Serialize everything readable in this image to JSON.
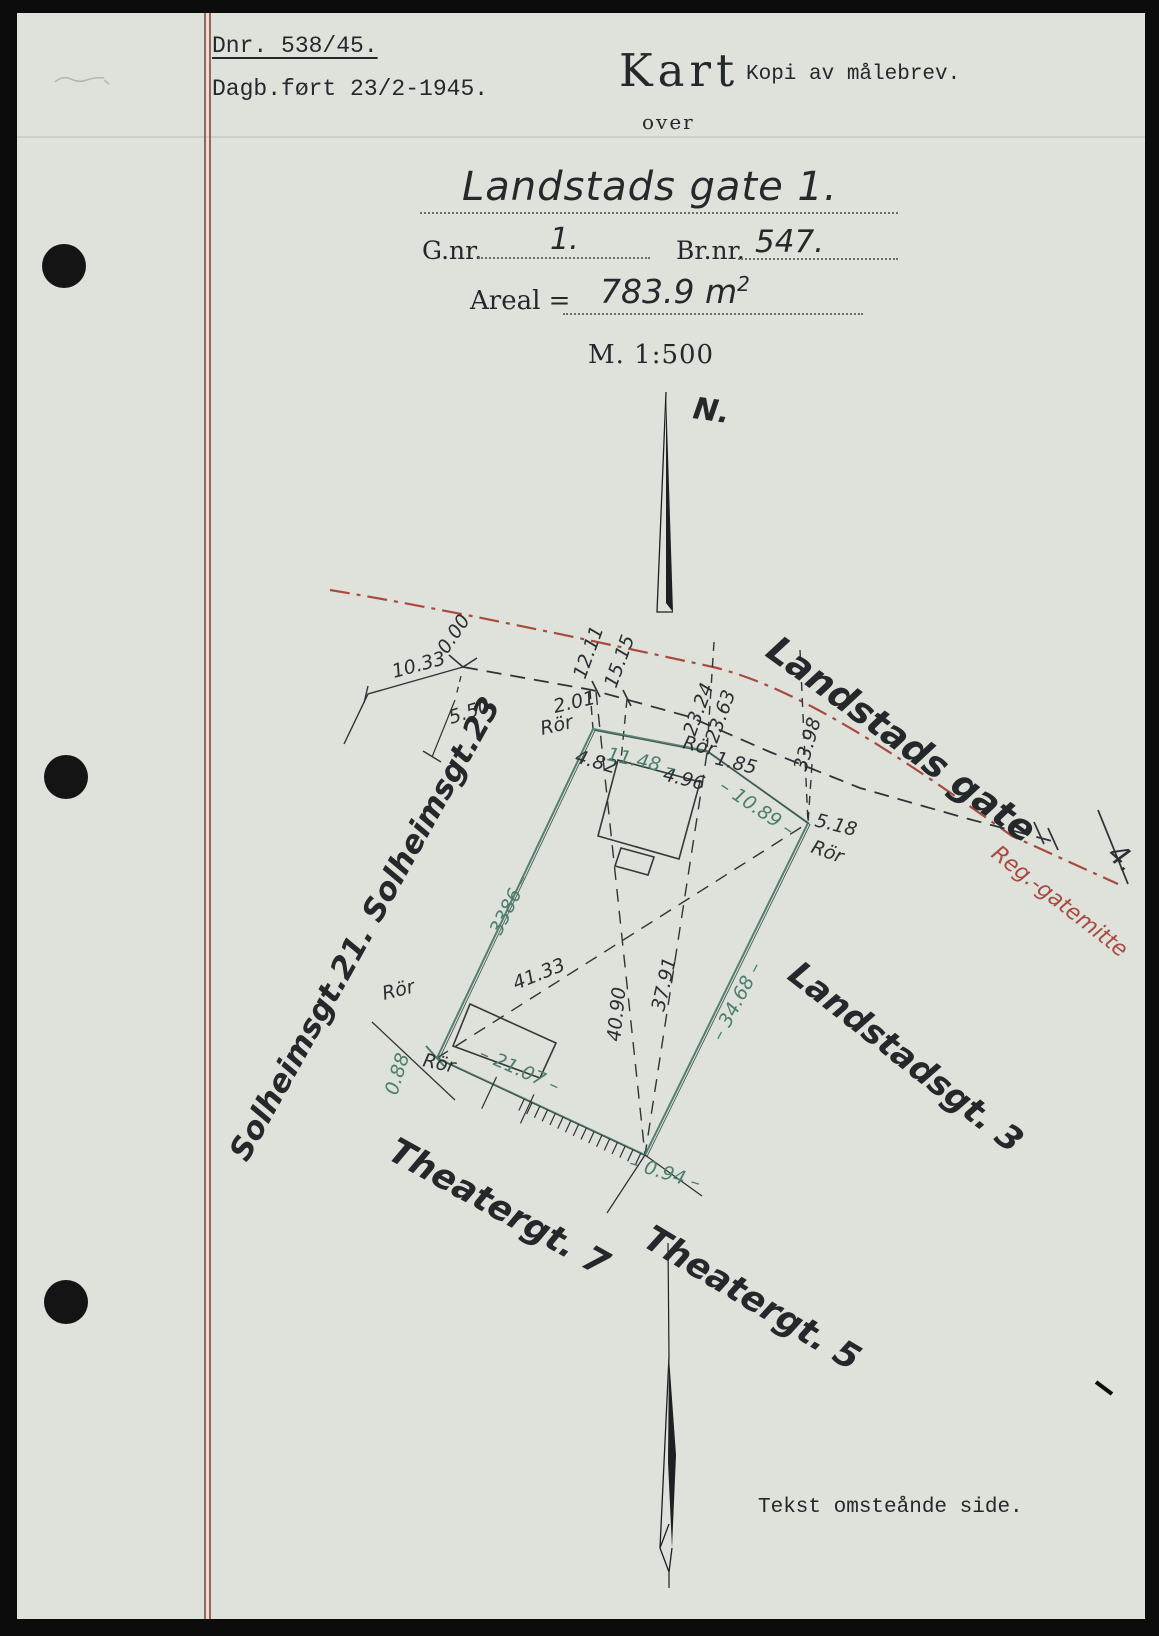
{
  "header": {
    "dnr": "Dnr. 538/45.",
    "dagb": "Dagb.ført 23/2-1945.",
    "kart": "Kart",
    "kopi": "Kopi av målebrev.",
    "over": "over"
  },
  "title": {
    "street": "Landstads gate 1.",
    "gnr_label": "G.nr.",
    "gnr_value": "1.",
    "brnr_label": "Br.nr.",
    "brnr_value": "547.",
    "areal_label": "Areal =",
    "areal_value": "783.9 m",
    "areal_sup": "2",
    "scale": "M. 1:500"
  },
  "footer": {
    "note": "Tekst omsteånde side."
  },
  "colors": {
    "paper": "#dee2db",
    "ink": "#2b2f31",
    "green": "#4c7e6c",
    "red": "#a84a3f"
  },
  "map": {
    "labels": [
      {
        "t": "10.33",
        "x": 394,
        "y": 678,
        "r": -15
      },
      {
        "t": "0.00",
        "x": 447,
        "y": 655,
        "r": -56
      },
      {
        "t": "5.50",
        "x": 451,
        "y": 724,
        "r": -17
      },
      {
        "t": "12.11",
        "x": 585,
        "y": 680,
        "r": -70
      },
      {
        "t": "15.15",
        "x": 616,
        "y": 689,
        "r": -70
      },
      {
        "t": "2.01",
        "x": 555,
        "y": 713,
        "r": -13
      },
      {
        "t": "Rör",
        "x": 542,
        "y": 735,
        "r": -13
      },
      {
        "t": "23.24",
        "x": 695,
        "y": 737,
        "r": -70
      },
      {
        "t": "23.63",
        "x": 717,
        "y": 744,
        "r": -70
      },
      {
        "t": "Rör",
        "x": 682,
        "y": 748,
        "r": 14
      },
      {
        "t": "1.85",
        "x": 714,
        "y": 764,
        "r": 14
      },
      {
        "t": "4.82",
        "x": 574,
        "y": 762,
        "r": 16
      },
      {
        "t": "4.96",
        "x": 662,
        "y": 780,
        "r": 14
      },
      {
        "t": "33.98",
        "x": 806,
        "y": 772,
        "r": -74
      },
      {
        "t": "5.18",
        "x": 814,
        "y": 826,
        "r": 14
      },
      {
        "t": "Rör",
        "x": 810,
        "y": 852,
        "r": 20
      },
      {
        "t": "41.33",
        "x": 516,
        "y": 990,
        "r": -22
      },
      {
        "t": "40.90",
        "x": 620,
        "y": 1042,
        "r": -84
      },
      {
        "t": "37.91",
        "x": 664,
        "y": 1012,
        "r": -77
      },
      {
        "t": "Rör",
        "x": 384,
        "y": 1000,
        "r": -14
      },
      {
        "t": "Rör",
        "x": 422,
        "y": 1066,
        "r": 12
      },
      {
        "t": "11.48 –",
        "x": 606,
        "y": 760,
        "r": 12,
        "c": "g"
      },
      {
        "t": "– 10.89 –",
        "x": 718,
        "y": 789,
        "r": 34,
        "c": "g"
      },
      {
        "t": "– 3386 –",
        "x": 494,
        "y": 950,
        "r": -64,
        "c": "g"
      },
      {
        "t": "– 34.68 –",
        "x": 722,
        "y": 1042,
        "r": -62,
        "c": "g"
      },
      {
        "t": "– 21.07 –",
        "x": 478,
        "y": 1058,
        "r": 24,
        "c": "g"
      },
      {
        "t": "0.88",
        "x": 397,
        "y": 1096,
        "r": -73,
        "c": "g"
      },
      {
        "t": "– 0.94 –",
        "x": 628,
        "y": 1168,
        "r": 17,
        "c": "g"
      },
      {
        "t": "Landstads gate",
        "x": 764,
        "y": 655,
        "r": 36,
        "c": "street",
        "fs": 37
      },
      {
        "t": "Landstadsgt. 3",
        "x": 786,
        "y": 978,
        "r": 38,
        "c": "street",
        "fs": 34
      },
      {
        "t": "Theatergt. 7",
        "x": 386,
        "y": 1158,
        "r": 29,
        "c": "street",
        "fs": 35
      },
      {
        "t": "Theatergt. 5",
        "x": 641,
        "y": 1245,
        "r": 31,
        "c": "street",
        "fs": 35
      },
      {
        "t": "Solheimsgt.21. Solheimsgt.23",
        "x": 247,
        "y": 1163,
        "r": -61,
        "c": "street",
        "fs": 31
      },
      {
        "t": "N.",
        "x": 692,
        "y": 418,
        "r": 8,
        "c": "street",
        "fs": 30
      },
      {
        "t": "Reg.-gatemitte",
        "x": 990,
        "y": 856,
        "r": 38,
        "c": "red",
        "fs": 22
      },
      {
        "t": "4.",
        "x": 1106,
        "y": 856,
        "r": 42,
        "fs": 28
      }
    ]
  }
}
